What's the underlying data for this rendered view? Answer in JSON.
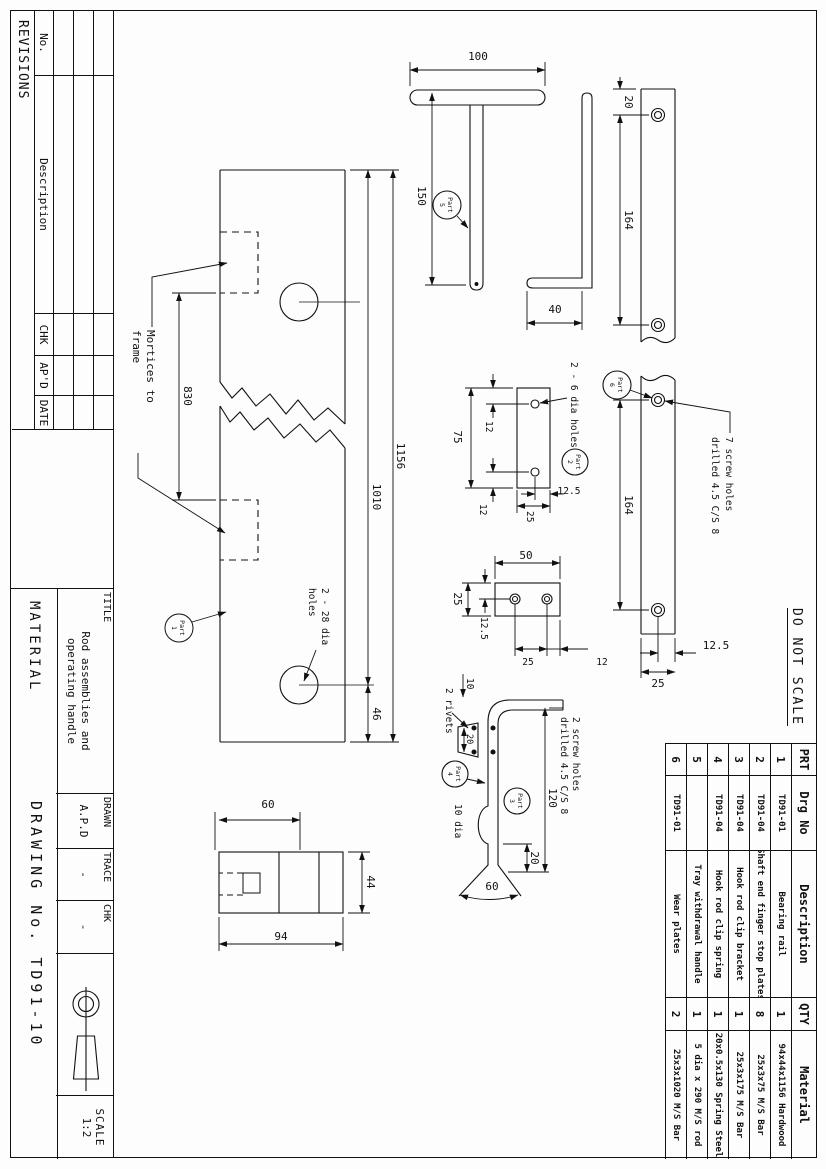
{
  "sheet": {
    "do_not_scale": "DO NOT SCALE"
  },
  "revisions": {
    "title": "REVISIONS",
    "headers": [
      "No.",
      "Description",
      "CHK",
      "AP'D",
      "DATE"
    ],
    "empty_rows": 3
  },
  "title_block": {
    "title_label": "TITLE",
    "title_line1": "Rod assemblies and",
    "title_line2": "operating handle",
    "material_label": "MATERIAL",
    "drawn_label": "DRAWN",
    "drawn_value": "A.P.D",
    "trace_label": "TRACE",
    "trace_value": "-",
    "chk_label": "CHK",
    "chk_value": "-",
    "drawing_no_label": "DRAWING No.",
    "drawing_no_value": "TD91-10",
    "scale_label": "SCALE",
    "scale_value": "1:2"
  },
  "parts_table": {
    "headers": [
      "PRT",
      "Drg No",
      "Description",
      "QTY",
      "Material"
    ],
    "rows": [
      [
        "1",
        "TD91-01",
        "Bearing rail",
        "1",
        "94x44x1156 Hardwood"
      ],
      [
        "2",
        "TD91-04",
        "Shaft end finger stop plates",
        "8",
        "25x3x75 M/S Bar"
      ],
      [
        "3",
        "TD91-04",
        "Hook rod clip bracket",
        "1",
        "25x3x175 M/S Bar"
      ],
      [
        "4",
        "TD91-04",
        "Hook rod clip spring",
        "1",
        "20x0.5x130 Spring Steel"
      ],
      [
        "5",
        "",
        "Tray withdrawal handle",
        "1",
        "5 dia x 290 M/S rod"
      ],
      [
        "6",
        "TD91-01",
        "Wear plates",
        "2",
        "25x3x1020 M/S Bar"
      ]
    ]
  },
  "drawing": {
    "labels": {
      "d1156": "1156",
      "d1010": "1010",
      "d46": "46",
      "d830": "830",
      "mort1": "Mortices to",
      "mort2": "frame",
      "holes28a": "2 - 28 dia",
      "holes28b": "holes",
      "d100": "100",
      "d150": "150",
      "d40": "40",
      "d60end": "60",
      "d44": "44",
      "d94": "94",
      "w20": "20",
      "w164a": "164",
      "w164b": "164",
      "w125": "12.5",
      "w25": "25",
      "screw7a": "7 screw holes",
      "screw7b": "drilled 4.5 C/S 8",
      "p2_75": "75",
      "p2_12a": "12",
      "p2_12b": "12",
      "p2_125": "12.5",
      "p2_25": "25",
      "p2_holes": "2 - 6 dia holes",
      "p3_50": "50",
      "p3_25w": "25",
      "p3_125": "12.5",
      "p3_25s": "25",
      "p3_12": "12",
      "c10": "10",
      "c_rivets": "2 rivets",
      "c20r": "20",
      "c10dia": "10 dia",
      "c120": "120",
      "c20b": "20",
      "c60": "60",
      "screw2a": "2 screw holes",
      "screw2b": "drilled 4.5 C/S 8"
    },
    "balloons": {
      "p1": [
        "Part",
        "1"
      ],
      "p2": [
        "Part",
        "2"
      ],
      "p3": [
        "Part",
        "3"
      ],
      "p4": [
        "Part",
        "4"
      ],
      "p5": [
        "Part",
        "5"
      ],
      "p6": [
        "Part",
        "6"
      ]
    }
  }
}
